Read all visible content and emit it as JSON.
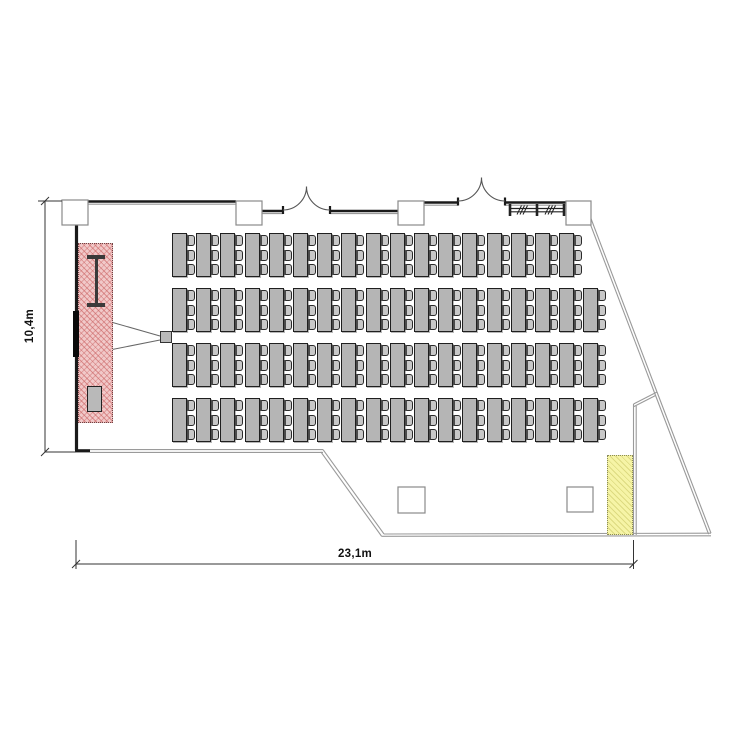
{
  "diagram": {
    "type": "floor-plan",
    "room_shape": "irregular-polygon",
    "dimensions": {
      "height_label": "10,4m",
      "width_label": "23,1m"
    },
    "seating": {
      "style": "classroom",
      "row_bands": 4,
      "tables_per_band": [
        17,
        18,
        18,
        18
      ],
      "table_count": 71,
      "chairs_per_table": 3,
      "total_chairs": 213
    },
    "fixtures": [
      "stage-area",
      "lectern",
      "projection-screen",
      "projector",
      "equipment-box",
      "double-door-entrance-1",
      "double-door-entrance-2",
      "wardrobe-rail",
      "storage-strip",
      "wall-columns",
      "floor-columns"
    ]
  },
  "furniture": {
    "pitch": 24.2,
    "table": {
      "width": 15,
      "height": 44
    },
    "chair": {
      "width": 8,
      "height": 11,
      "offsets": [
        2,
        16.5,
        31
      ]
    },
    "bands": [
      {
        "x": 172,
        "y": 233,
        "count": 17
      },
      {
        "x": 172,
        "y": 288,
        "count": 18
      },
      {
        "x": 172,
        "y": 343,
        "count": 18
      },
      {
        "x": 172,
        "y": 398,
        "count": 18
      }
    ]
  },
  "colors": {
    "wall": "#1a1a1a",
    "wall_thin": "#9a9a9a",
    "dimension": "#333333",
    "stage_fill": "#f1c9c9",
    "stage_hatch": "#c65858",
    "storage_fill": "#f6f4a6",
    "table_fill": "#b5b5b5",
    "chair_fill": "#c8c8c8",
    "screen": "#0a0a0a"
  }
}
